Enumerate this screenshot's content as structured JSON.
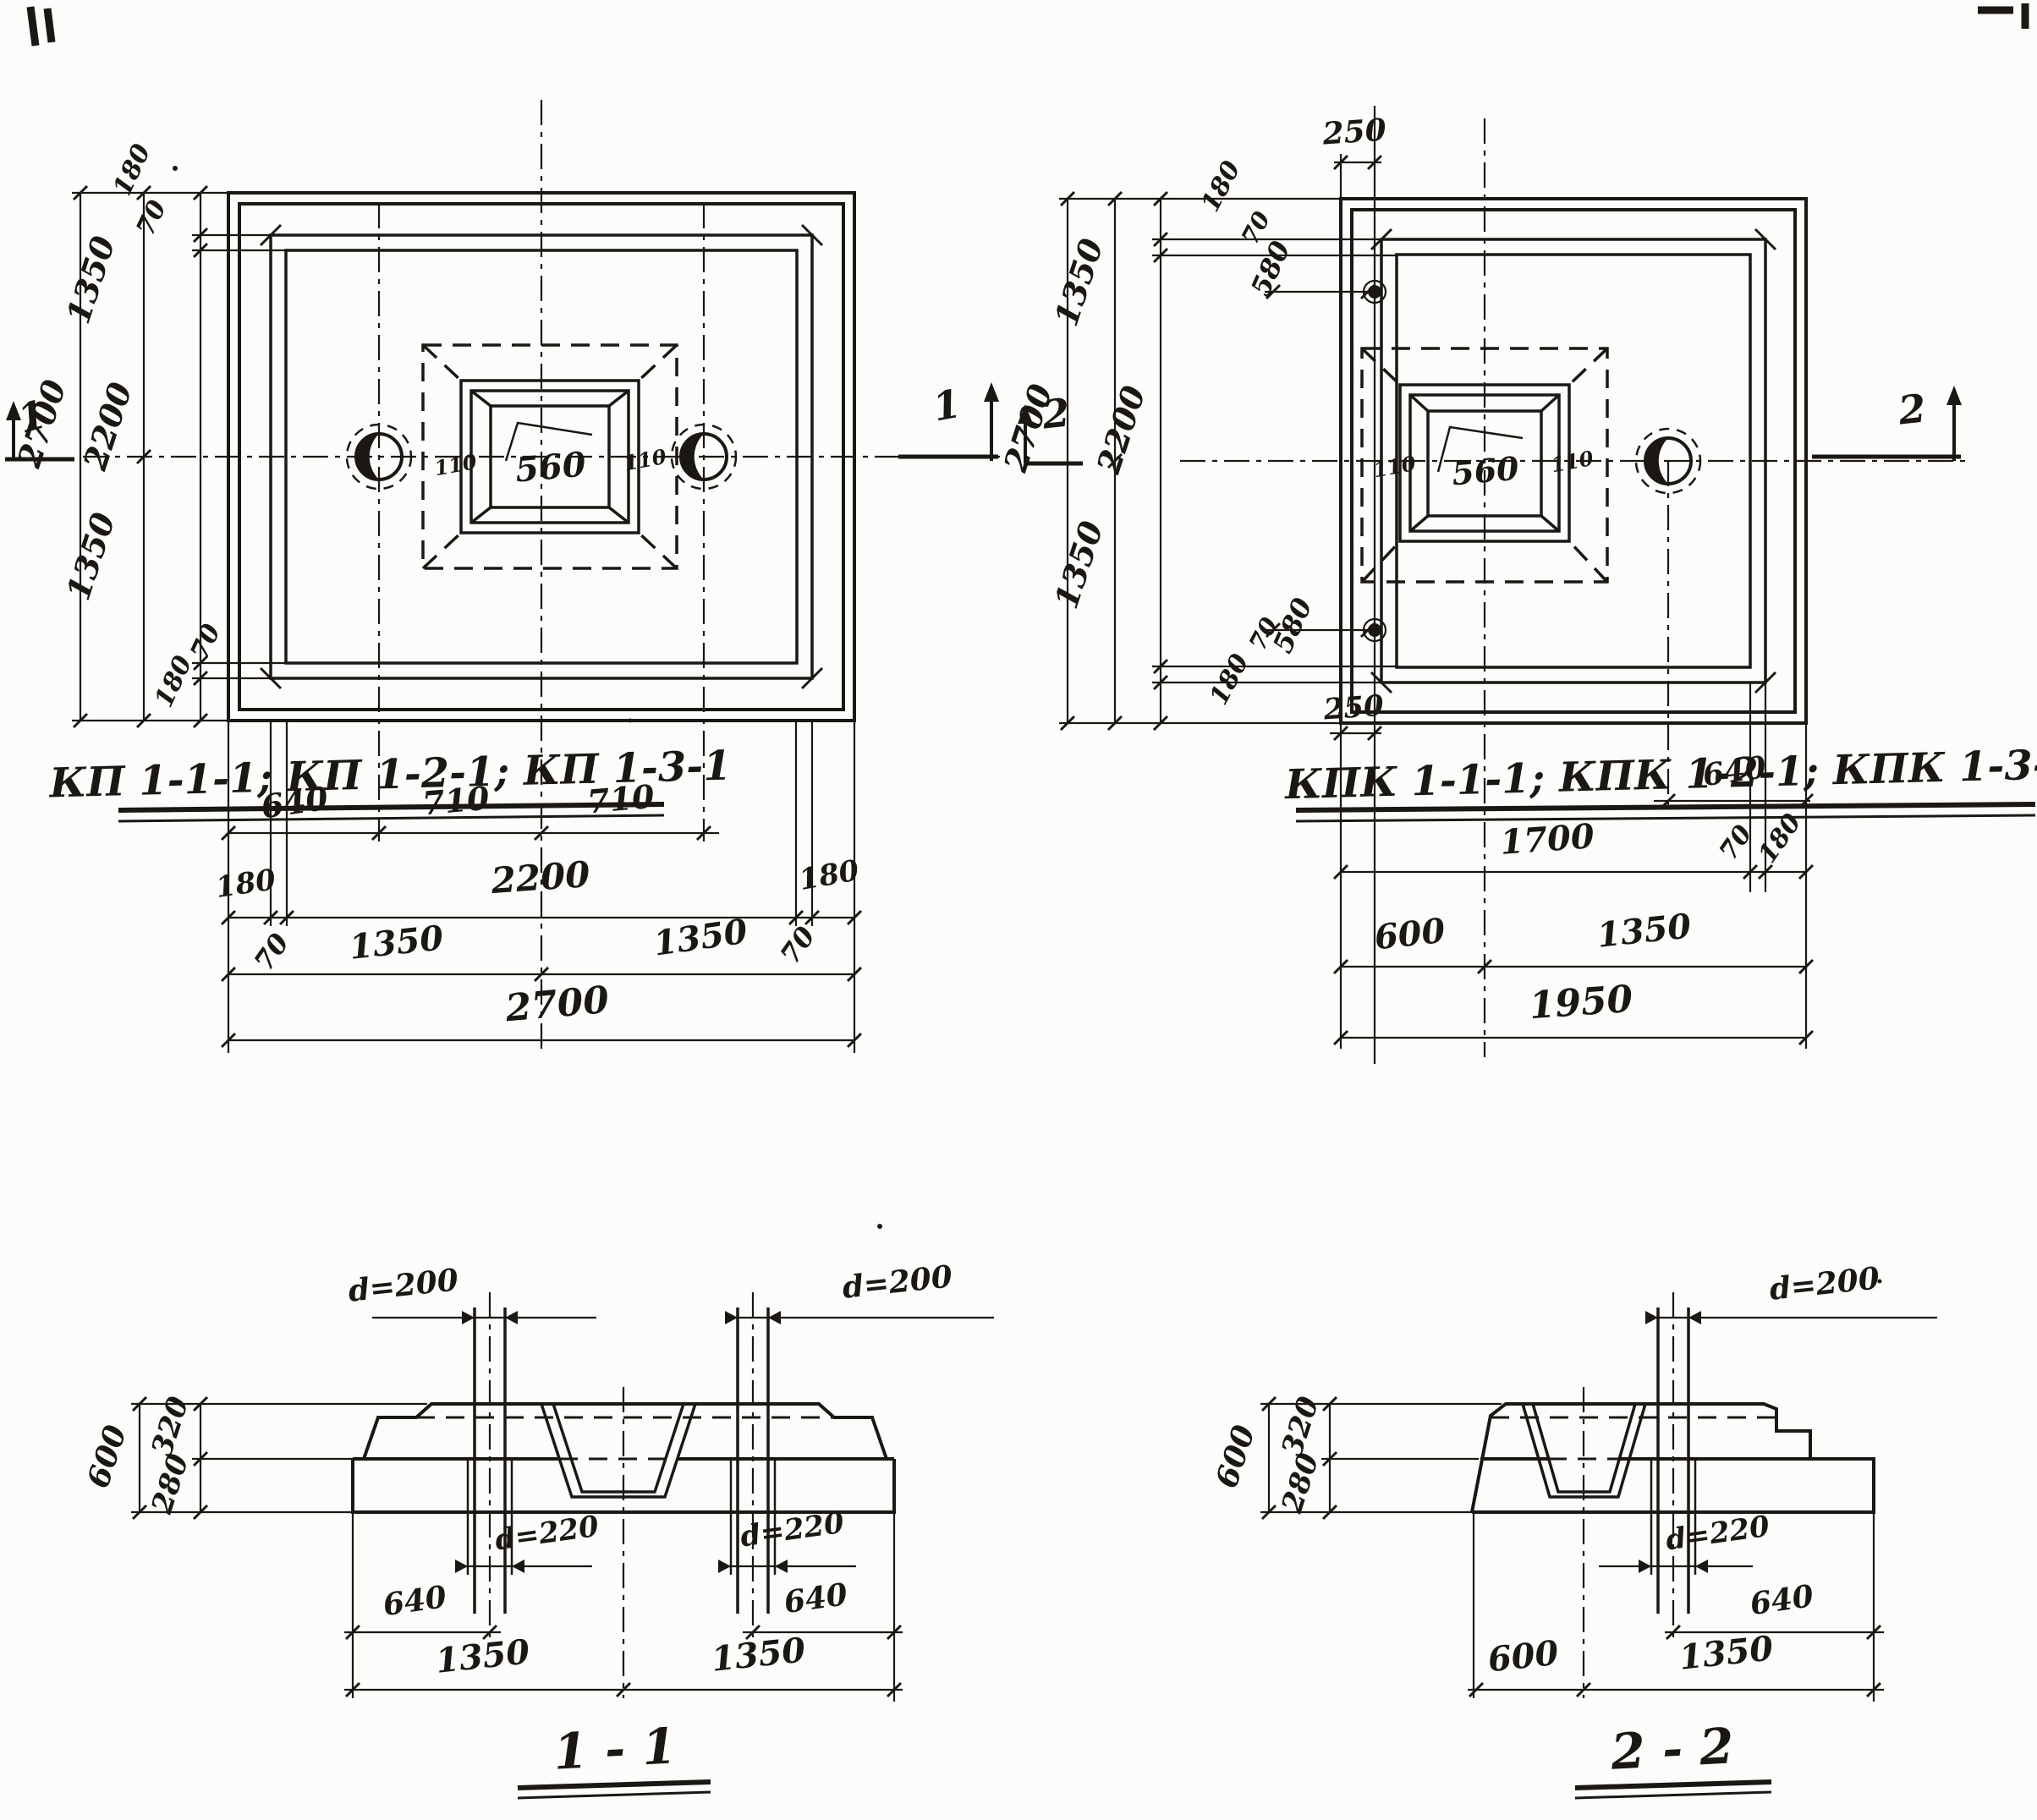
{
  "page": {
    "paper_color": "#fcfcfa",
    "ink_color": "#1b1714",
    "type": "scanned engineering drawing, precast foundation plans and sections"
  },
  "plan_kp": {
    "title": "КП 1-1-1; КП 1-2-1; КП 1-3-1",
    "marker_left": "1",
    "marker_right": "1",
    "dim_total_v": "2700",
    "dim_half_top": "1350",
    "dim_inner_v": "2200",
    "dim_half_bottom": "1350",
    "dim_edge_top": "180",
    "dim_offset_top": "70",
    "dim_offset_bottom": "70",
    "dim_edge_bottom": "180",
    "dim_pile_left": "640",
    "dim_pile_mid_left": "710",
    "dim_pile_mid_right": "710",
    "dim_edge_left": "180",
    "dim_inner_h": "2200",
    "dim_edge_right": "180",
    "dim_offset_left": "70",
    "dim_offset_right": "70",
    "dim_half_left": "1350",
    "dim_half_right": "1350",
    "dim_total_h": "2700",
    "socket_size": "560",
    "socket_wall_left": "110",
    "socket_wall_right": "110"
  },
  "plan_kpk": {
    "title": "КПК 1-1-1; КПК 1-2-1; КПК 1-3-1",
    "marker_left": "2",
    "marker_right": "2",
    "dim_bolt_top": "250",
    "dim_bolt_bottom": "250",
    "dim_total_v": "2700",
    "dim_half_top": "1350",
    "dim_inner_v": "2200",
    "dim_half_bottom": "1350",
    "dim_edge_top": "180",
    "dim_offset_top": "70",
    "dim_bolt_off_top": "580",
    "dim_offset_bottom": "70",
    "dim_bolt_off_bottom": "580",
    "dim_edge_bottom": "180",
    "dim_pile_right": "640",
    "dim_w1700": "1700",
    "dim_w70": "70",
    "dim_w180": "180",
    "dim_w600": "600",
    "dim_w1350": "1350",
    "dim_total_h": "1950",
    "socket_size": "560",
    "socket_wall_left": "110",
    "socket_wall_right": "110"
  },
  "section_11": {
    "title": "1 - 1",
    "pipe_left": "d=200",
    "pipe_right": "d=200",
    "hole_left": "d=220",
    "hole_right": "d=220",
    "h_total": "600",
    "h_top": "320",
    "h_bottom": "280",
    "b_left_640": "640",
    "b_right_640": "640",
    "b_left_1350": "1350",
    "b_right_1350": "1350"
  },
  "section_22": {
    "title": "2 - 2",
    "pipe": "d=200",
    "hole": "d=220",
    "h_total": "600",
    "h_top": "320",
    "h_bottom": "280",
    "b_640": "640",
    "b_600": "600",
    "b_1350": "1350"
  }
}
